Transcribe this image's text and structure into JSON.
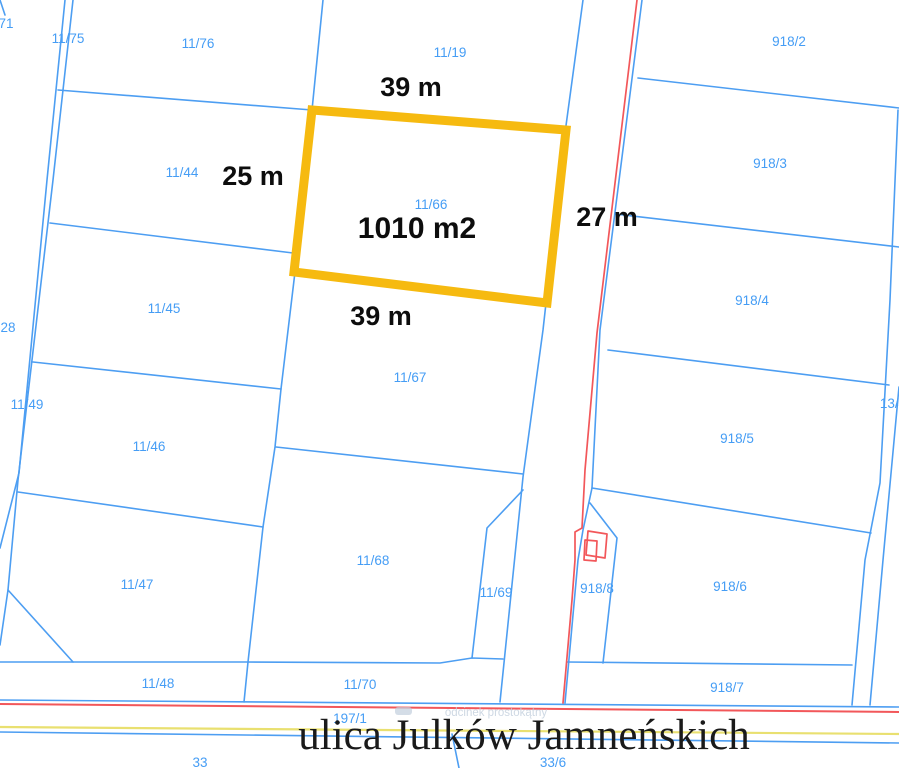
{
  "map": {
    "colors": {
      "line_blue": "#4d9ef2",
      "label_blue": "#459df5",
      "line_red": "#f2575a",
      "street_yellow": "#e9e070",
      "highlight_yellow": "#f6ba10",
      "dim_black": "#0d0d0d",
      "street_text": "#1a1a1a",
      "watermark": "#c2cfdd",
      "background": "#ffffff"
    },
    "street": {
      "text": "ulica Julków Jamneńskich",
      "x": 524,
      "y": 749
    },
    "watermark": {
      "text": "odcinek prostokątny",
      "x": 496,
      "y": 716,
      "tag": {
        "x": 395,
        "y": 707,
        "w": 17,
        "h": 8
      }
    },
    "highlight": {
      "parcel_number": {
        "text": "11/66",
        "x": 431,
        "y": 209
      },
      "area": {
        "text": "1010 m2",
        "x": 417,
        "y": 238
      },
      "polygon": [
        [
          312,
          110
        ],
        [
          566,
          130
        ],
        [
          547,
          303
        ],
        [
          294,
          272
        ]
      ],
      "stroke_width": 9
    },
    "dimensions": [
      {
        "text": "39 m",
        "x": 411,
        "y": 96
      },
      {
        "text": "25 m",
        "x": 253,
        "y": 185
      },
      {
        "text": "27 m",
        "x": 607,
        "y": 226
      },
      {
        "text": "39 m",
        "x": 381,
        "y": 325
      }
    ],
    "parcel_labels": [
      {
        "text": "71",
        "x": 6,
        "y": 28
      },
      {
        "text": "11/75",
        "x": 68,
        "y": 43
      },
      {
        "text": "11/76",
        "x": 198,
        "y": 48
      },
      {
        "text": "11/19",
        "x": 450,
        "y": 57
      },
      {
        "text": "918/2",
        "x": 789,
        "y": 46
      },
      {
        "text": "918/3",
        "x": 770,
        "y": 168
      },
      {
        "text": "11/44",
        "x": 182,
        "y": 177
      },
      {
        "text": "11/45",
        "x": 164,
        "y": 313
      },
      {
        "text": "28",
        "x": 8,
        "y": 332
      },
      {
        "text": "918/4",
        "x": 752,
        "y": 305
      },
      {
        "text": "11/49",
        "x": 27,
        "y": 409
      },
      {
        "text": "11/46",
        "x": 149,
        "y": 451
      },
      {
        "text": "11/67",
        "x": 410,
        "y": 382
      },
      {
        "text": "918/5",
        "x": 737,
        "y": 443
      },
      {
        "text": "13/4",
        "x": 893,
        "y": 408
      },
      {
        "text": "11/47",
        "x": 137,
        "y": 589
      },
      {
        "text": "11/68",
        "x": 373,
        "y": 565
      },
      {
        "text": "11/69",
        "x": 496,
        "y": 597
      },
      {
        "text": "918/8",
        "x": 597,
        "y": 593
      },
      {
        "text": "918/6",
        "x": 730,
        "y": 591
      },
      {
        "text": "11/48",
        "x": 158,
        "y": 688
      },
      {
        "text": "11/70",
        "x": 360,
        "y": 689
      },
      {
        "text": "918/7",
        "x": 727,
        "y": 692
      },
      {
        "text": "197/1",
        "x": 350,
        "y": 723
      },
      {
        "text": "33",
        "x": 200,
        "y": 767
      },
      {
        "text": "33/6",
        "x": 553,
        "y": 767
      }
    ],
    "lines": [
      {
        "name": "left-road-west-edge",
        "color": "line_blue",
        "w": 1.6,
        "pts": [
          [
            65,
            0
          ],
          [
            47,
            180
          ],
          [
            19,
            473
          ],
          [
            0,
            548
          ]
        ]
      },
      {
        "name": "left-road-east-edge",
        "color": "line_blue",
        "w": 1.6,
        "pts": [
          [
            73,
            0
          ],
          [
            53,
            180
          ],
          [
            18,
            480
          ],
          [
            8,
            590
          ],
          [
            0,
            645
          ]
        ]
      },
      {
        "name": "top-left-corner-fragment",
        "color": "line_blue",
        "w": 1.6,
        "pts": [
          [
            0,
            0
          ],
          [
            5,
            15
          ]
        ]
      },
      {
        "name": "parcel-47-diagonal",
        "color": "line_blue",
        "w": 1.6,
        "pts": [
          [
            8,
            590
          ],
          [
            73,
            662
          ]
        ]
      },
      {
        "name": "mid-north-south-boundary",
        "color": "line_blue",
        "w": 1.6,
        "pts": [
          [
            323,
            0
          ],
          [
            312,
            110
          ],
          [
            295,
            272
          ],
          [
            281,
            389
          ],
          [
            275,
            447
          ],
          [
            263,
            527
          ],
          [
            248,
            662
          ],
          [
            244,
            702
          ]
        ]
      },
      {
        "name": "boundary-75-44",
        "color": "line_blue",
        "w": 1.6,
        "pts": [
          [
            58,
            90
          ],
          [
            312,
            110
          ]
        ]
      },
      {
        "name": "boundary-44-45",
        "color": "line_blue",
        "w": 1.6,
        "pts": [
          [
            50,
            223
          ],
          [
            293,
            253
          ]
        ]
      },
      {
        "name": "boundary-45-46",
        "color": "line_blue",
        "w": 1.6,
        "pts": [
          [
            33,
            362
          ],
          [
            281,
            389
          ]
        ]
      },
      {
        "name": "boundary-46-47",
        "color": "line_blue",
        "w": 1.6,
        "pts": [
          [
            18,
            492
          ],
          [
            263,
            527
          ]
        ]
      },
      {
        "name": "boundary-47-48-70",
        "color": "line_blue",
        "w": 1.6,
        "pts": [
          [
            0,
            662
          ],
          [
            245,
            662
          ],
          [
            440,
            663
          ],
          [
            472,
            658
          ],
          [
            503,
            659
          ]
        ]
      },
      {
        "name": "boundary-67-68",
        "color": "line_blue",
        "w": 1.6,
        "pts": [
          [
            276,
            447
          ],
          [
            523,
            474
          ]
        ]
      },
      {
        "name": "road-west-edge",
        "color": "line_blue",
        "w": 1.6,
        "pts": [
          [
            583,
            0
          ],
          [
            565,
            133
          ],
          [
            543,
            330
          ],
          [
            523,
            477
          ],
          [
            500,
            702
          ]
        ]
      },
      {
        "name": "road-east-edge",
        "color": "line_blue",
        "w": 1.6,
        "pts": [
          [
            642,
            0
          ],
          [
            600,
            330
          ],
          [
            592,
            488
          ],
          [
            583,
            530
          ],
          [
            578,
            560
          ],
          [
            565,
            703
          ]
        ]
      },
      {
        "name": "parcel-69-west-edge",
        "color": "line_blue",
        "w": 1.6,
        "pts": [
          [
            523,
            490
          ],
          [
            487,
            528
          ],
          [
            472,
            658
          ]
        ]
      },
      {
        "name": "boundary-918-2-3",
        "color": "line_blue",
        "w": 1.6,
        "pts": [
          [
            638,
            78
          ],
          [
            899,
            108
          ]
        ]
      },
      {
        "name": "boundary-918-3-4",
        "color": "line_blue",
        "w": 1.6,
        "pts": [
          [
            615,
            214
          ],
          [
            899,
            247
          ]
        ]
      },
      {
        "name": "boundary-918-4-5",
        "color": "line_blue",
        "w": 1.6,
        "pts": [
          [
            608,
            350
          ],
          [
            889,
            385
          ]
        ]
      },
      {
        "name": "boundary-918-5-6",
        "color": "line_blue",
        "w": 1.6,
        "pts": [
          [
            592,
            488
          ],
          [
            871,
            533
          ]
        ]
      },
      {
        "name": "boundary-918-6-7",
        "color": "line_blue",
        "w": 1.6,
        "pts": [
          [
            567,
            662
          ],
          [
            852,
            665
          ]
        ]
      },
      {
        "name": "parcel-918-8-outline",
        "color": "line_blue",
        "w": 1.6,
        "pts": [
          [
            590,
            503
          ],
          [
            617,
            538
          ],
          [
            603,
            663
          ]
        ]
      },
      {
        "name": "east-strip-west-edge",
        "color": "line_blue",
        "w": 1.6,
        "pts": [
          [
            898,
            110
          ],
          [
            890,
            300
          ],
          [
            880,
            483
          ],
          [
            865,
            560
          ],
          [
            852,
            705
          ]
        ]
      },
      {
        "name": "east-strip-east-edge",
        "color": "line_blue",
        "w": 1.6,
        "pts": [
          [
            899,
            387
          ],
          [
            883,
            560
          ],
          [
            870,
            705
          ]
        ]
      },
      {
        "name": "street-north-edge",
        "color": "line_blue",
        "w": 1.6,
        "pts": [
          [
            0,
            700
          ],
          [
            899,
            707
          ]
        ]
      },
      {
        "name": "street-south-edge",
        "color": "line_blue",
        "w": 1.6,
        "pts": [
          [
            0,
            732
          ],
          [
            899,
            743
          ]
        ]
      },
      {
        "name": "below-street-diagonal",
        "color": "line_blue",
        "w": 1.6,
        "pts": [
          [
            452,
            734
          ],
          [
            459,
            768
          ]
        ]
      },
      {
        "name": "road-axis-red-line",
        "color": "line_red",
        "w": 1.7,
        "pts": [
          [
            637,
            0
          ],
          [
            597,
            333
          ],
          [
            585,
            470
          ],
          [
            582,
            528
          ],
          [
            575,
            532
          ],
          [
            575,
            560
          ],
          [
            572,
            600
          ],
          [
            563,
            703
          ]
        ]
      },
      {
        "name": "street-red-line",
        "color": "line_red",
        "w": 2,
        "pts": [
          [
            0,
            704
          ],
          [
            899,
            712
          ]
        ]
      },
      {
        "name": "street-yellow-line",
        "color": "street_yellow",
        "w": 2.2,
        "pts": [
          [
            0,
            727
          ],
          [
            899,
            734
          ]
        ]
      },
      {
        "name": "building-outline-1",
        "color": "line_red",
        "w": 1.7,
        "closed": true,
        "pts": [
          [
            588,
            531
          ],
          [
            607,
            534
          ],
          [
            605,
            558
          ],
          [
            586,
            555
          ]
        ]
      },
      {
        "name": "building-outline-2",
        "color": "line_red",
        "w": 1.7,
        "closed": true,
        "pts": [
          [
            585,
            540
          ],
          [
            597,
            541
          ],
          [
            596,
            561
          ],
          [
            584,
            560
          ]
        ]
      }
    ]
  }
}
